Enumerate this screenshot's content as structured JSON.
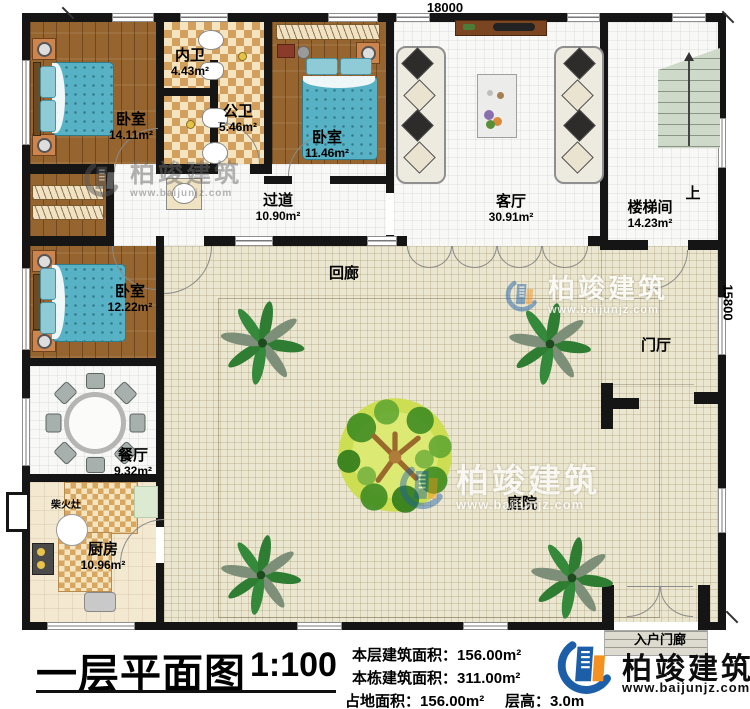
{
  "palette": {
    "wall": "#151515",
    "wood_floor": "#96652f",
    "tile_tan": "#d2a05c",
    "bed_teal": "#58b2c5",
    "courtyard": "#ebe6cf",
    "brand_blue": "#1c5fa8",
    "brand_orange": "#f59120"
  },
  "dimensions": {
    "top": "18000",
    "right": "15800"
  },
  "rooms": {
    "bedroom1": {
      "name": "卧室",
      "area": "14.11m²"
    },
    "inner_bath": {
      "name": "内卫",
      "area": "4.43m²"
    },
    "public_bath": {
      "name": "公卫",
      "area": "5.46m²"
    },
    "bedroom2": {
      "name": "卧室",
      "area": "11.46m²"
    },
    "corridor": {
      "name": "过道",
      "area": "10.90m²"
    },
    "living": {
      "name": "客厅",
      "area": "30.91m²"
    },
    "stairwell": {
      "name": "楼梯间",
      "area": "14.23m²"
    },
    "bedroom3": {
      "name": "卧室",
      "area": "12.22m²"
    },
    "dining": {
      "name": "餐厅",
      "area": "9.32m²"
    },
    "kitchen": {
      "name": "厨房",
      "area": "10.96m²"
    },
    "cloister": {
      "name": "回廊"
    },
    "courtyard": {
      "name": "庭院"
    },
    "foyer": {
      "name": "门厅"
    },
    "porch": {
      "name": "入户门廊"
    },
    "stove": {
      "name": "柴火灶"
    },
    "stairs_up": {
      "name": "上"
    }
  },
  "title_block": {
    "plan_title": "一层平面图",
    "scale": "1:100"
  },
  "stats": {
    "floor_area_label": "本层建筑面积：",
    "floor_area_value": "156.00m²",
    "building_area_label": "本栋建筑面积：",
    "building_area_value": "311.00m²",
    "footprint_label": "占地面积：",
    "footprint_value": "156.00m²",
    "height_label": "层高：",
    "height_value": "3.0m"
  },
  "brand": {
    "name": "柏竣建筑",
    "url": "www.baijunjz.com"
  }
}
